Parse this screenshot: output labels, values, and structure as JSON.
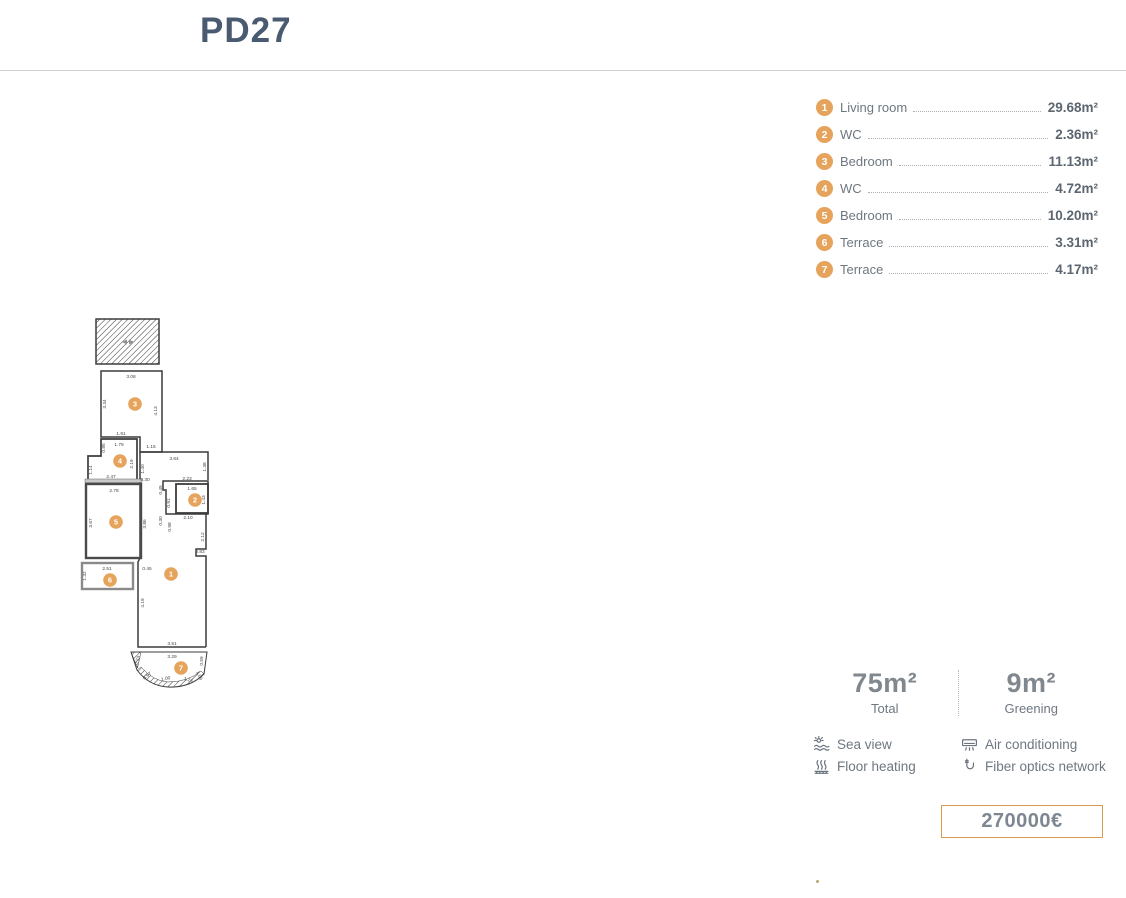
{
  "header": {
    "title": "PD27"
  },
  "legend": {
    "items": [
      {
        "num": "1",
        "label": "Living room",
        "area": "29.68m²"
      },
      {
        "num": "2",
        "label": "WC",
        "area": "2.36m²"
      },
      {
        "num": "3",
        "label": "Bedroom",
        "area": "11.13m²"
      },
      {
        "num": "4",
        "label": "WC",
        "area": "4.72m²"
      },
      {
        "num": "5",
        "label": "Bedroom",
        "area": "10.20m²"
      },
      {
        "num": "6",
        "label": "Terrace",
        "area": "3.31m²"
      },
      {
        "num": "7",
        "label": "Terrace",
        "area": "4.17m²"
      }
    ]
  },
  "floorplan": {
    "rooms": [
      {
        "num": "1",
        "x": 171,
        "y": 574
      },
      {
        "num": "2",
        "x": 195,
        "y": 500
      },
      {
        "num": "3",
        "x": 135,
        "y": 404
      },
      {
        "num": "4",
        "x": 120,
        "y": 461
      },
      {
        "num": "5",
        "x": 116,
        "y": 522
      },
      {
        "num": "6",
        "x": 110,
        "y": 580
      },
      {
        "num": "7",
        "x": 181,
        "y": 668
      }
    ],
    "dimensions": [
      {
        "text": "3.08",
        "x": 131,
        "y": 378
      },
      {
        "text": "3.34",
        "x": 106,
        "y": 404,
        "rotate": -90
      },
      {
        "text": "4.13",
        "x": 157,
        "y": 411,
        "rotate": -90
      },
      {
        "text": "1.91",
        "x": 121,
        "y": 435
      },
      {
        "text": "1.79",
        "x": 119,
        "y": 446
      },
      {
        "text": "0.85",
        "x": 105,
        "y": 448,
        "rotate": -90
      },
      {
        "text": "1.15",
        "x": 151,
        "y": 448
      },
      {
        "text": "2.19",
        "x": 133,
        "y": 464,
        "rotate": -90
      },
      {
        "text": "1.14",
        "x": 92,
        "y": 470,
        "rotate": -90
      },
      {
        "text": "2.47",
        "x": 111,
        "y": 478
      },
      {
        "text": "3.64",
        "x": 174,
        "y": 460
      },
      {
        "text": "1.38",
        "x": 206,
        "y": 467,
        "rotate": -90
      },
      {
        "text": "1.40",
        "x": 144,
        "y": 469,
        "rotate": -90
      },
      {
        "text": "0.30",
        "x": 145,
        "y": 481
      },
      {
        "text": "2.23",
        "x": 187,
        "y": 480
      },
      {
        "text": "0.45",
        "x": 162,
        "y": 490,
        "rotate": -90
      },
      {
        "text": "1.65",
        "x": 192,
        "y": 490
      },
      {
        "text": "1.43",
        "x": 205,
        "y": 500,
        "rotate": -90
      },
      {
        "text": "0.91",
        "x": 170,
        "y": 503,
        "rotate": -90
      },
      {
        "text": "2.78",
        "x": 114,
        "y": 492
      },
      {
        "text": "3.67",
        "x": 92,
        "y": 523,
        "rotate": -90
      },
      {
        "text": "3.86",
        "x": 146,
        "y": 524,
        "rotate": -90
      },
      {
        "text": "0.30",
        "x": 162,
        "y": 521,
        "rotate": -90
      },
      {
        "text": "2.10",
        "x": 188,
        "y": 519
      },
      {
        "text": "0.98",
        "x": 171,
        "y": 527,
        "rotate": -90
      },
      {
        "text": "2.12",
        "x": 204,
        "y": 537,
        "rotate": -90
      },
      {
        "text": "0.83",
        "x": 200,
        "y": 553
      },
      {
        "text": "2.51",
        "x": 107,
        "y": 570
      },
      {
        "text": "1.32",
        "x": 86,
        "y": 576,
        "rotate": -90
      },
      {
        "text": "0.45",
        "x": 147,
        "y": 570
      },
      {
        "text": "4.19",
        "x": 144,
        "y": 603,
        "rotate": -90
      },
      {
        "text": "3.51",
        "x": 172,
        "y": 645
      },
      {
        "text": "3.29",
        "x": 172,
        "y": 658
      },
      {
        "text": "0.73",
        "x": 139,
        "y": 661,
        "rotate": -72
      },
      {
        "text": "0.97",
        "x": 148,
        "y": 677,
        "rotate": -38
      },
      {
        "text": "1.00",
        "x": 166,
        "y": 680,
        "rotate": -12
      },
      {
        "text": "1.24",
        "x": 188,
        "y": 681,
        "rotate": 14
      },
      {
        "text": "1.09",
        "x": 198,
        "y": 676,
        "rotate": 68
      },
      {
        "text": "0.59",
        "x": 203,
        "y": 661,
        "rotate": -90
      }
    ]
  },
  "summary": {
    "total": {
      "value": "75m²",
      "label": "Total"
    },
    "greening": {
      "value": "9m²",
      "label": "Greening"
    },
    "features_left": [
      {
        "icon": "sea-view-icon",
        "label": "Sea view"
      },
      {
        "icon": "floor-heating-icon",
        "label": "Floor heating"
      }
    ],
    "features_right": [
      {
        "icon": "air-conditioning-icon",
        "label": "Air conditioning"
      },
      {
        "icon": "fiber-optics-icon",
        "label": "Fiber optics network"
      }
    ],
    "price": "270000€"
  },
  "colors": {
    "accent": "#E6A35C",
    "title": "#4A5A70",
    "label_text": "#6E7780",
    "value_text": "#5C6670",
    "big_number": "#80878E",
    "price_border": "#D89B4F",
    "price_text": "#7D8792",
    "wall": "#3C3C3C"
  }
}
